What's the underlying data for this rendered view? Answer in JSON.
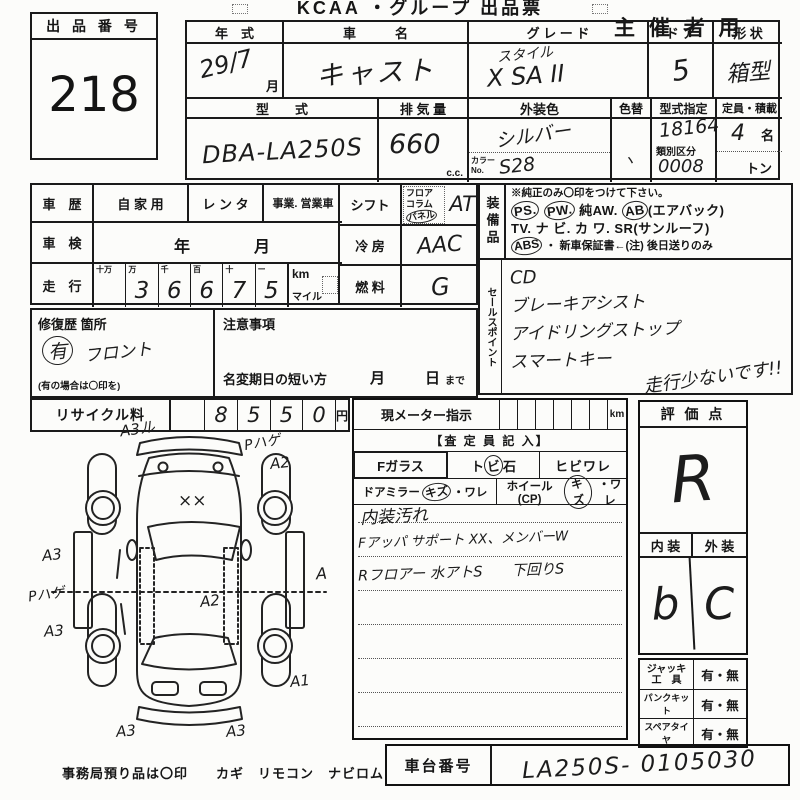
{
  "header": {
    "title": "KCAA ・グループ 出品票",
    "audience": "主 催 者 用"
  },
  "lot": {
    "label": "出 品 番 号",
    "number": "218"
  },
  "top": {
    "year_label": "年　式",
    "year": "29/7",
    "year_unit": "月",
    "name_label": "車　　　名",
    "name": "キャスト",
    "grade_label": "グ レ ー ド",
    "grade1": "スタイル",
    "grade2": "X SA II",
    "door_label": "ド ア",
    "door": "5",
    "shape_label": "形 状",
    "shape": "箱型",
    "model_label": "型　　式",
    "model": "DBA-LA250S",
    "disp_label": "排 気 量",
    "disp": "660",
    "disp_unit": "c.c.",
    "color_label": "外装色",
    "color": "シルバー",
    "color_no_label": "カラー",
    "color_no_label2": "No.",
    "color_no": "S28",
    "recolor_label": "色替",
    "recolor_mark": "ヽ",
    "type_no_label": "型式指定",
    "type_no": "18164",
    "class_label": "類別区分",
    "class_no": "0008",
    "cap_label": "定員・積載",
    "cap": "4",
    "cap_unit": "名",
    "load_unit": "トン"
  },
  "history": {
    "label": "車　歴",
    "opt1": "自 家 用",
    "opt2": "レ ン タ",
    "opt3": "事業. 営業車"
  },
  "inspection": {
    "label": "車　検",
    "year": "年",
    "month": "月"
  },
  "mileage": {
    "label": "走　行",
    "digit_labels": [
      "十万",
      "万",
      "千",
      "百",
      "十",
      "ー"
    ],
    "digits": [
      "",
      "3",
      "6",
      "6",
      "7",
      "5"
    ],
    "unit_km": "km",
    "unit_mile": "マイル"
  },
  "shift": {
    "label": "シフト",
    "opt1": "フロア",
    "opt2": "コラム",
    "opt3": "パネル",
    "value": "AT"
  },
  "ac": {
    "label": "冷 房",
    "value": "AAC"
  },
  "fuel": {
    "label": "燃 料",
    "value": "G"
  },
  "equipment": {
    "label": "装備品",
    "note": "※純正のみ〇印をつけて下さい。",
    "i1": "PS.",
    "i2": "PW.",
    "i3": "純AW.",
    "i4": "AB",
    "i4b": "(エアバック)",
    "i5": "TV.",
    "i6": "ナ ビ.",
    "i7": "カ ワ.",
    "i8": "SR(サンルーフ)",
    "i9": "ABS",
    "i10": "・ 新車保証書←(注) 後日送りのみ"
  },
  "sales": {
    "label": "セールスポイント",
    "line1": "CD",
    "line2": "ブレーキアシスト",
    "line3": "アイドリングストップ",
    "line4": "スマートキー",
    "extra": "走行少ないです!!"
  },
  "repair": {
    "label": "修復歴 箇所",
    "mark": "有",
    "text": "フロント",
    "note": "(有の場合は〇印を)"
  },
  "caution": {
    "label": "注意事項",
    "line": "名変期日の短い方",
    "month": "月",
    "day": "日",
    "day_suffix": "まで"
  },
  "recycle": {
    "label": "リサイクル料",
    "digits": [
      "8",
      "5",
      "5",
      "0"
    ],
    "unit": "円"
  },
  "meter": {
    "label": "現メーター指示",
    "unit": "km",
    "assessor": "【査 定 員 記 入】",
    "glass": {
      "label": "Fガラス",
      "o1a": "ト",
      "o1b": "ビ",
      "o1c": "石",
      "o2": "ヒビワレ"
    },
    "mirror": {
      "label": "ドアミラー",
      "kizu": "キズ",
      "ware": "・ワレ"
    },
    "wheel": {
      "label": "ホイール(CP)",
      "kizu": "キズ",
      "ware": "・ワレ"
    },
    "notes": [
      "内装汚れ",
      "Fアッパ サポート XX、メンバーW",
      "Rフロアー 水アトS　　下回りS"
    ]
  },
  "score": {
    "label": "評 価 点",
    "value": "R",
    "interior_label": "内 装",
    "exterior_label": "外 装",
    "interior": "b",
    "exterior": "C"
  },
  "tools": {
    "rows": [
      {
        "l1": "ジャッキ",
        "l2": "工　具",
        "v": "有・無"
      },
      {
        "l1": "パンクキット",
        "l2": "",
        "v": "有・無"
      },
      {
        "l1": "スペアタイヤ",
        "l2": "",
        "v": "有・無"
      }
    ]
  },
  "chassis": {
    "label": "車台番号",
    "value": "LA250S- 0105030"
  },
  "footer": {
    "note": "事務局預り品は〇印　　カギ　リモコン　ナビロム"
  },
  "diagram": {
    "hood_mark": "××",
    "annotations": [
      {
        "text": "A3ル"
      },
      {
        "text": "Pハゲ"
      },
      {
        "text": "A2"
      },
      {
        "text": "A3"
      },
      {
        "text": "Pハゲ"
      },
      {
        "text": "A3"
      },
      {
        "text": "A2"
      },
      {
        "text": "A"
      },
      {
        "text": "A1"
      },
      {
        "text": "A3"
      },
      {
        "text": "A3"
      }
    ]
  }
}
